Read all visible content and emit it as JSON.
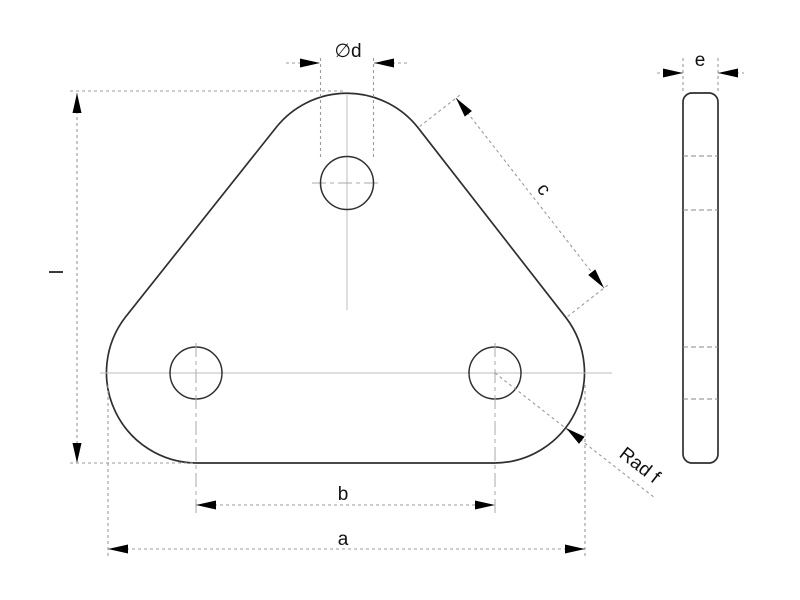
{
  "drawing": {
    "labels": {
      "diameter": "∅d",
      "thickness": "e",
      "height": "l",
      "edge_length": "c",
      "hole_spacing": "b",
      "width": "a",
      "corner_radius": "Rad f"
    },
    "colors": {
      "part_outline": "#2f2f2f",
      "dimension_lines": "#9b9b9b",
      "centerlines": "#bcbcbc",
      "hidden_lines": "#8a8a8a",
      "arrowheads": "#000000",
      "text": "#111111",
      "background": "#ffffff"
    }
  }
}
